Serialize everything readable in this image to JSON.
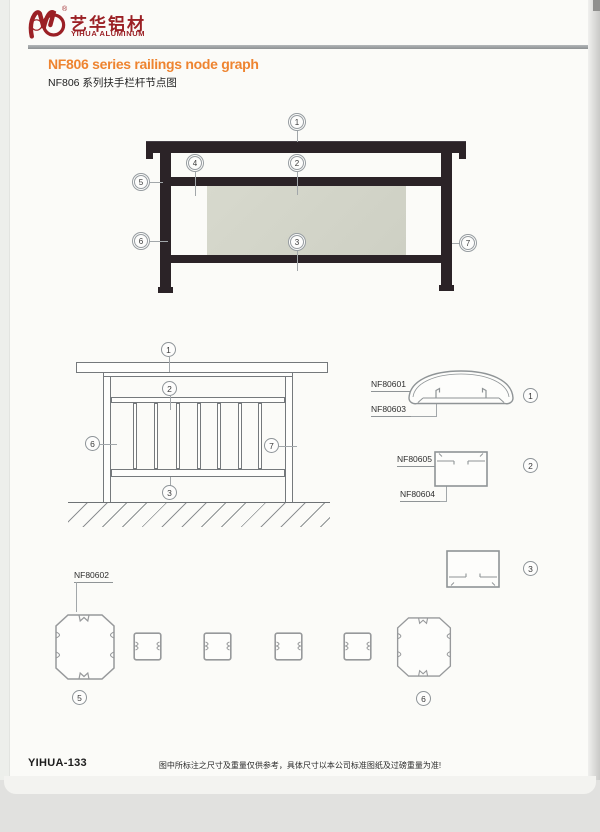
{
  "header": {
    "brand_cn": "艺华铝材",
    "brand_en": "YIHUA ALUMINUM",
    "registered_mark": "®"
  },
  "title": {
    "en": "NF806 series railings node graph",
    "cn": "NF806 系列扶手栏杆节点图"
  },
  "colors": {
    "brand_red": "#9b2025",
    "title_orange": "#ee8430",
    "rail_dark": "#2b2327",
    "glass_gray": "#d5d7cb",
    "line_gray": "#75797c",
    "paper": "#fbfbf8"
  },
  "drawing1": {
    "description": "dark railing elevation",
    "callouts": [
      "1",
      "2",
      "3",
      "4",
      "5",
      "6",
      "7"
    ]
  },
  "drawing2": {
    "description": "railing line elevation with balusters and ground hatch",
    "callouts": [
      "1",
      "2",
      "3",
      "6",
      "7"
    ]
  },
  "details": {
    "d1": {
      "num": "1",
      "labels": [
        "NF80601",
        "NF80603"
      ]
    },
    "d2": {
      "num": "2",
      "labels": [
        "NF80605",
        "NF80604"
      ]
    },
    "d3": {
      "num": "3"
    },
    "d5": {
      "num": "5",
      "label": "NF80602"
    },
    "d6": {
      "num": "6"
    }
  },
  "footer": {
    "page_code": "YIHUA-133",
    "note": "图中所标注之尺寸及重量仅供参考，具体尺寸以本公司标准图纸及过磅重量为准!"
  }
}
